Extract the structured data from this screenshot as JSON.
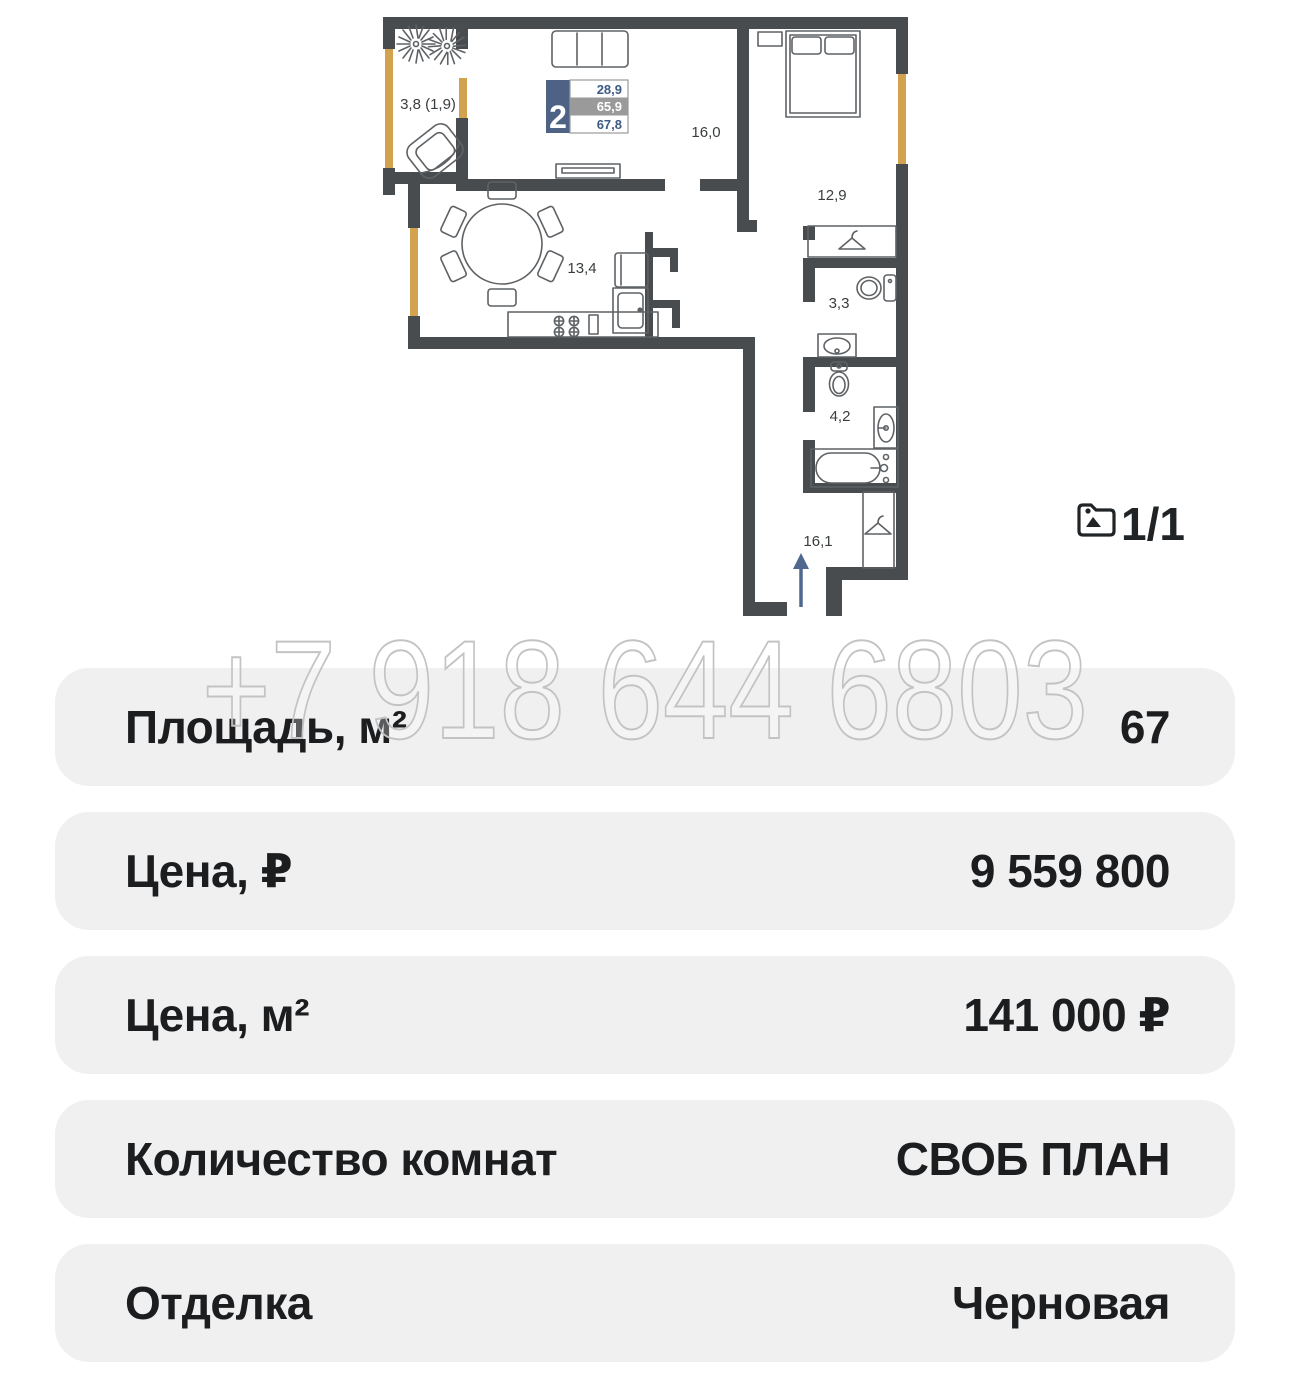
{
  "plan": {
    "rooms": [
      {
        "id": "balcony",
        "label": "3,8 (1,9)"
      },
      {
        "id": "living",
        "label": "16,0"
      },
      {
        "id": "bedroom",
        "label": "12,9"
      },
      {
        "id": "kitchen",
        "label": "13,4"
      },
      {
        "id": "bathroom",
        "label": "3,3"
      },
      {
        "id": "wc",
        "label": "4,2"
      },
      {
        "id": "hallway",
        "label": "16,1"
      }
    ],
    "legend": {
      "rooms_count": "2",
      "row1": "28,9",
      "row2": "65,9",
      "row3": "67,8"
    },
    "pager": {
      "icon": "image-icon",
      "label": "1/1"
    }
  },
  "watermark": "+7 918 644 6803",
  "details": [
    {
      "label": "Площадь, м²",
      "value": "67"
    },
    {
      "label": "Цена, ₽",
      "value": "9 559 800"
    },
    {
      "label": "Цена, м²",
      "value": "141 000 ₽"
    },
    {
      "label": "Количество комнат",
      "value": "СВОБ ПЛАН"
    },
    {
      "label": "Отделка",
      "value": "Черновая"
    }
  ],
  "colors": {
    "wall": "#494c4e",
    "window": "#d2a24e",
    "furn": "#5f6265",
    "plan-label": "#3a3d3f",
    "legend-blue": "#4d6285",
    "legend-gray": "#9a9a9b",
    "legend-num": "#3e5b84",
    "arrow": "#50678f",
    "row-bg": "#f0f0f1",
    "text": "#1b1d1f",
    "wm": "#c3c3c3"
  }
}
